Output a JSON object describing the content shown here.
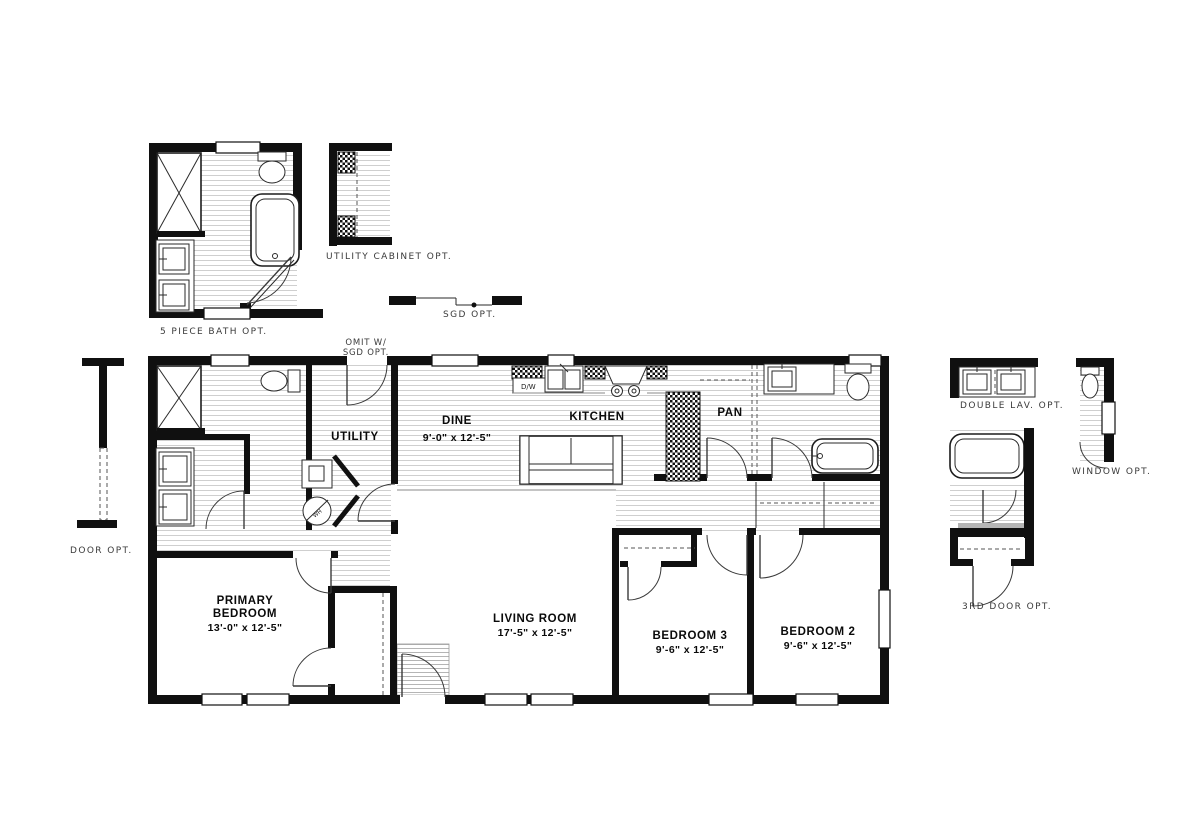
{
  "rooms": {
    "utility": {
      "name": "UTILITY"
    },
    "dine": {
      "name": "DINE",
      "dims": "9'-0\" x  12'-5\""
    },
    "kitchen": {
      "name": "KITCHEN"
    },
    "pantry": {
      "name": "PAN"
    },
    "primary_bedroom": {
      "name_line1": "PRIMARY",
      "name_line2": "BEDROOM",
      "dims": "13'-0\" x  12'-5\""
    },
    "living_room": {
      "name": "LIVING ROOM",
      "dims": "17'-5\" x  12'-5\""
    },
    "bedroom_3": {
      "name": "BEDROOM 3",
      "dims": "9'-6\" x  12'-5\""
    },
    "bedroom_2": {
      "name": "BEDROOM 2",
      "dims": "9'-6\" x  12'-5\""
    }
  },
  "options": {
    "five_piece_bath": "5 PIECE BATH OPT.",
    "utility_cabinet": "UTILITY CABINET OPT.",
    "sgd": "SGD OPT.",
    "omit_line1": "OMIT W/",
    "omit_line2": "SGD OPT.",
    "door": "DOOR OPT.",
    "double_lav": "DOUBLE LAV. OPT.",
    "window": "WINDOW OPT.",
    "third_door": "3RD DOOR OPT."
  },
  "fixtures": {
    "dishwasher": "D/W",
    "water_heater": "WH"
  },
  "colors": {
    "wall": "#101010",
    "floor_line": "#cfcfcf",
    "option_label": "#3a3a3a",
    "ink": "#0a0a0a"
  }
}
